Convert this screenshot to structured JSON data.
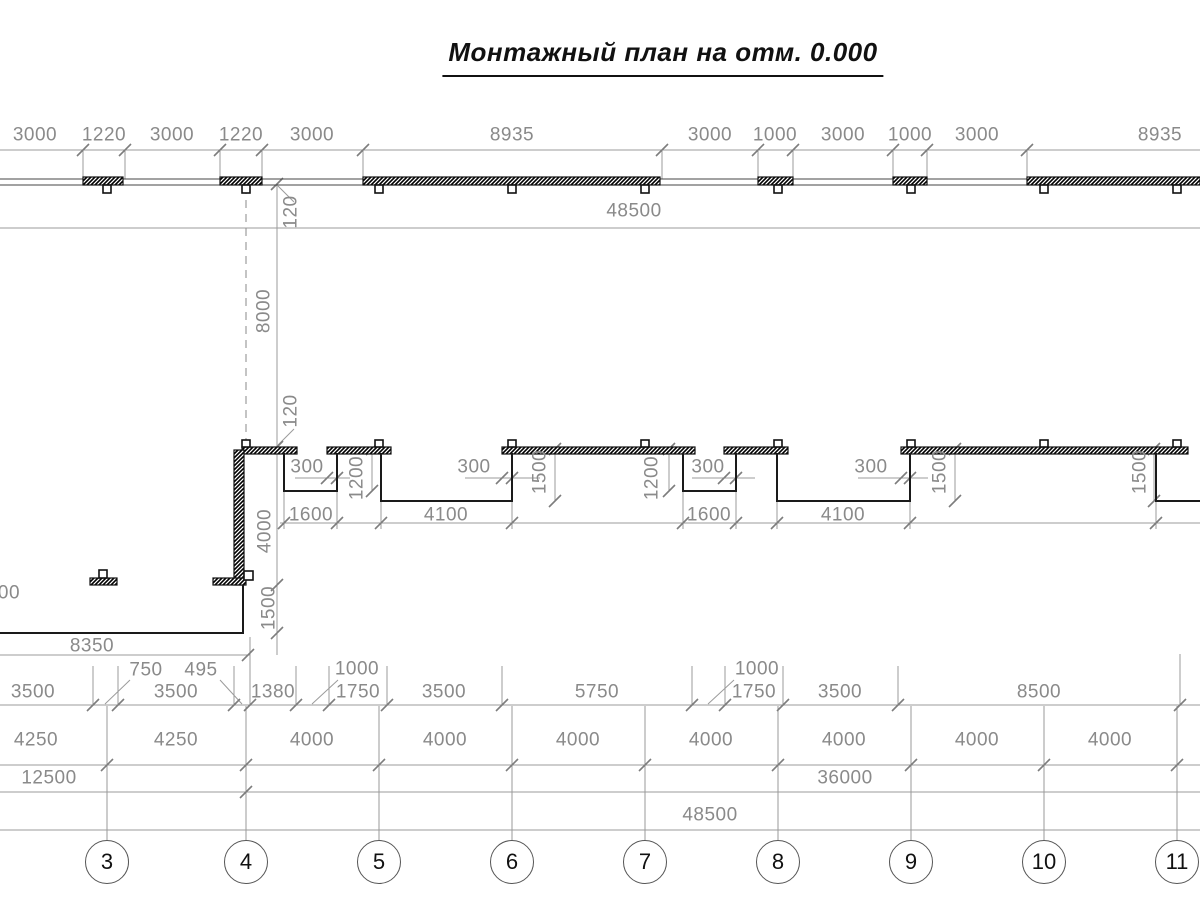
{
  "title": "Монтажный план на отм. 0.000",
  "overall": {
    "top": "48500",
    "bottom": "48500"
  },
  "top_chain": [
    "3000",
    "1220",
    "3000",
    "1220",
    "3000",
    "8935",
    "3000",
    "1000",
    "3000",
    "1000",
    "3000",
    "8935"
  ],
  "vertical_chain": [
    "120",
    "8000",
    "120",
    "4000",
    "1500"
  ],
  "notch_dims": {
    "overhang": "300",
    "small_width": "1600",
    "small_depth": "1200",
    "large_width": "4100",
    "large_depth": "1500"
  },
  "left_bottom": {
    "length": "8350",
    "partial_label": "00"
  },
  "row2_chain": [
    "3500",
    "750",
    "3500",
    "495",
    "1380",
    "1000",
    "1750",
    "3500",
    "5750",
    "1000",
    "1750",
    "3500",
    "8500"
  ],
  "row3_chain": [
    "4250",
    "4250",
    "4000",
    "4000",
    "4000",
    "4000",
    "4000",
    "4000",
    "4000"
  ],
  "row4_chain": [
    "12500",
    "36000"
  ],
  "axis_labels": [
    "3",
    "4",
    "5",
    "6",
    "7",
    "8",
    "9",
    "10",
    "11"
  ]
}
